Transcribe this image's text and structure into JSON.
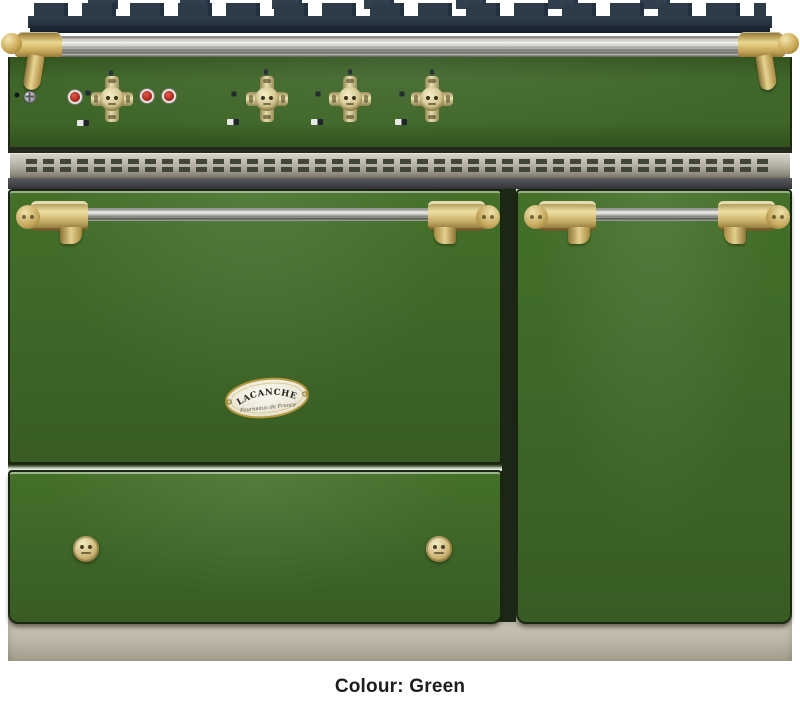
{
  "image": {
    "subject": "Lacanche range cooker, front view, product photo"
  },
  "caption": {
    "text": "Colour: Green"
  },
  "badge": {
    "brand": "LACANCHE",
    "tagline": "Fourneaux de France"
  },
  "colors": {
    "body_green": "#3e6527",
    "grate_navy": "#2c3a48",
    "rail_steel": "#c9c7c1",
    "vent_steel": "#b2aea2",
    "brass": "#c9b06b",
    "plinth_beige": "#bfb8a9",
    "indicator_red": "#b03028",
    "caption_text": "#1d1d1d"
  },
  "stove": {
    "parts": [
      "cast-iron-pan-supports",
      "front-towel-rail",
      "control-panel",
      "vent-grille",
      "left-oven-door",
      "right-oven-door",
      "storage-drawer",
      "plinth"
    ],
    "panel": {
      "burner_knobs": [
        {
          "cx": 102,
          "cy": 42
        },
        {
          "cx": 257,
          "cy": 42
        },
        {
          "cx": 340,
          "cy": 42
        },
        {
          "cx": 422,
          "cy": 42
        }
      ],
      "markers": [
        {
          "type": "black-dot",
          "x": 7,
          "y": 38
        },
        {
          "type": "screw",
          "x": 20,
          "y": 40
        },
        {
          "type": "red-light",
          "x": 65,
          "y": 40
        },
        {
          "type": "red-light",
          "x": 137,
          "y": 39
        },
        {
          "type": "red-light",
          "x": 159,
          "y": 39
        },
        {
          "type": "top-dot",
          "x": 101,
          "y": 16
        },
        {
          "type": "top-dot",
          "x": 256,
          "y": 15
        },
        {
          "type": "top-dot",
          "x": 340,
          "y": 15
        },
        {
          "type": "top-dot",
          "x": 422,
          "y": 15
        },
        {
          "type": "side-tick",
          "x": 78,
          "y": 36
        },
        {
          "type": "side-tick",
          "x": 224,
          "y": 37
        },
        {
          "type": "side-tick",
          "x": 308,
          "y": 37
        },
        {
          "type": "side-tick",
          "x": 392,
          "y": 37
        },
        {
          "type": "glyph",
          "x": 73,
          "y": 66
        },
        {
          "type": "glyph",
          "x": 223,
          "y": 65
        },
        {
          "type": "glyph",
          "x": 307,
          "y": 65
        },
        {
          "type": "glyph",
          "x": 391,
          "y": 65
        }
      ]
    },
    "drawer": {
      "knobs": [
        {
          "x": 76,
          "y": 77
        },
        {
          "x": 429,
          "y": 77
        }
      ]
    }
  }
}
